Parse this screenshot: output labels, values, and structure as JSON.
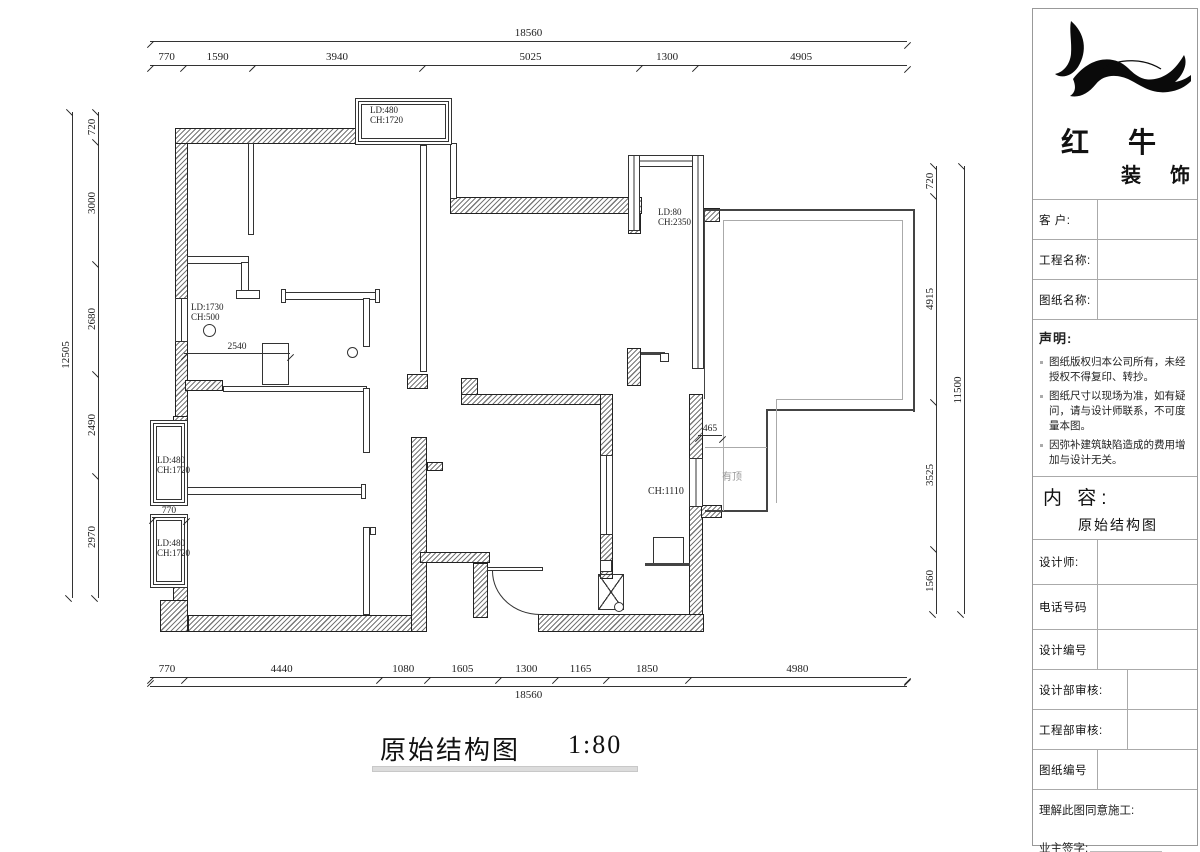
{
  "plan": {
    "caption": {
      "title": "原始结构图",
      "scale": "1:80"
    },
    "dims": {
      "top": {
        "total": "18560",
        "segments": [
          "770",
          "1590",
          "3940",
          "5025",
          "1300",
          "4905"
        ]
      },
      "bottom": {
        "total": "18560",
        "segments": [
          "770",
          "4440",
          "1080",
          "1605",
          "1300",
          "1165",
          "1850",
          "4980"
        ]
      },
      "left": {
        "total": "12505",
        "segments": [
          "720",
          "3000",
          "2680",
          "2490",
          "2970"
        ]
      },
      "right": {
        "total": "11500",
        "segments": [
          "720",
          "4915",
          "3525",
          "1560"
        ]
      }
    },
    "annotations": {
      "win_top": {
        "l1": "LD:480",
        "l2": "CH:1720"
      },
      "win_right": {
        "l1": "LD:80",
        "l2": "CH:2350"
      },
      "door_balcony": {
        "l1": "LD:1730",
        "l2": "CH:500"
      },
      "win_left_up": {
        "l1": "LD:480",
        "l2": "CH:1720"
      },
      "win_left_low": {
        "l1": "LD:480",
        "l2": "CH:1720"
      },
      "d2540": "2540",
      "d770": "770",
      "d465": "465",
      "ch1110": "CH:1110",
      "covered": "有顶"
    }
  },
  "titleblock": {
    "brand": {
      "name": "红 牛",
      "suffix": "装 饰"
    },
    "fields": {
      "client": "客  户:",
      "project": "工程名称:",
      "drawing": "图纸名称:",
      "designer": "设计师:",
      "phone": "电话号码",
      "design_no": "设计编号",
      "design_review": "设计部审核:",
      "engineering_review": "工程部审核:",
      "drawing_no": "图纸编号",
      "agree": "理解此图同意施工:",
      "owner_sign": "业主签字:"
    },
    "statement": {
      "heading": "声明:",
      "items": [
        "图纸版权归本公司所有，未经授权不得复印、转抄。",
        "图纸尺寸以现场为准，如有疑问，请与设计师联系，不可度量本图。",
        "因弥补建筑缺陷造成的费用增加与设计无关。"
      ]
    },
    "content": {
      "heading": "内 容:",
      "value": "原始结构图"
    }
  },
  "colors": {
    "line": "#333333",
    "hatch_wall": "#777777",
    "gray_text": "#999999",
    "underline": "#dcdcdc"
  }
}
